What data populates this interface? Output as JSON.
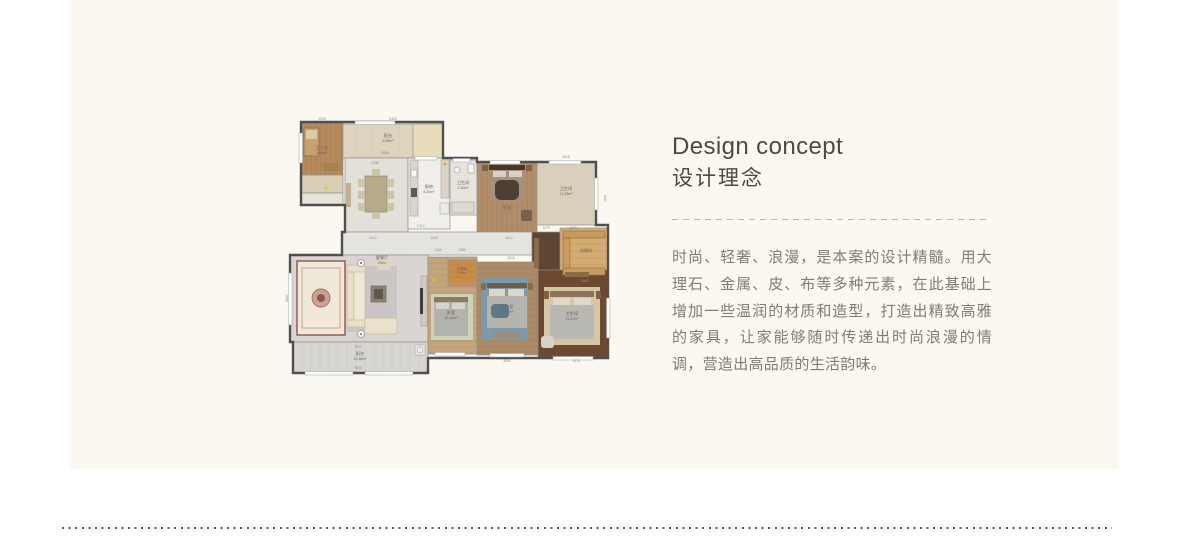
{
  "page": {
    "background": "#ffffff",
    "panel_bg": "#faf8f0"
  },
  "content": {
    "heading_en": "Design concept",
    "heading_zh": "设计理念",
    "paragraph": "时尚、轻奢、浪漫，是本案的设计精髓。用大理石、金属、皮、布等多种元素，在此基础上增加一些温润的材质和造型，打造出精致高雅的家具，让家能够随时传递出时尚浪漫的情调，营造出高品质的生活韵味。"
  },
  "floorplan": {
    "colors": {
      "wall": "#4f4f4f",
      "inner_wall": "#8f8f8f",
      "label": "#6a665e",
      "dim": "#8c8c8c"
    },
    "outline": "M16,14 H158 V50 H192 V54 H311 V117 H323 V250 H143 V265 H8 V234 H5 V147 H57 V124 H60 V97 H16 Z",
    "rooms": [
      {
        "name": "study",
        "x": 16,
        "y": 15,
        "w": 42,
        "h": 52,
        "fill": "#b58a5c"
      },
      {
        "name": "study-closet",
        "x": 16,
        "y": 67,
        "w": 42,
        "h": 18,
        "fill": "#d9cfb6"
      },
      {
        "name": "study-terrace",
        "x": 16,
        "y": 85,
        "w": 42,
        "h": 12,
        "fill": "#e7e3d8"
      },
      {
        "name": "balcony-top",
        "x": 58,
        "y": 16,
        "w": 100,
        "h": 34,
        "fill": "#ddd3bf"
      },
      {
        "name": "balcony-top-cabinet",
        "x": 128,
        "y": 16,
        "w": 30,
        "h": 34,
        "fill": "#e9dcba"
      },
      {
        "name": "dining",
        "x": 60,
        "y": 50,
        "w": 63,
        "h": 74,
        "fill": "#e3e0da"
      },
      {
        "name": "kitchen",
        "x": 123,
        "y": 50,
        "w": 42,
        "h": 71,
        "fill": "#f0efeb"
      },
      {
        "name": "bath-small",
        "x": 165,
        "y": 52,
        "w": 27,
        "h": 55,
        "fill": "#e6e4df"
      },
      {
        "name": "bedroom-top",
        "x": 192,
        "y": 54,
        "w": 60,
        "h": 70,
        "fill": "#b18d6a"
      },
      {
        "name": "bath-top-right",
        "x": 252,
        "y": 54,
        "w": 59,
        "h": 63,
        "fill": "#d8d0bd"
      },
      {
        "name": "corridor",
        "x": 57,
        "y": 124,
        "w": 190,
        "h": 23,
        "fill": "#e6e4df"
      },
      {
        "name": "entry",
        "x": 247,
        "y": 124,
        "w": 30,
        "h": 45,
        "fill": "#5e4534"
      },
      {
        "name": "closet-right",
        "x": 275,
        "y": 120,
        "w": 48,
        "h": 49,
        "fill": "#d3ac73"
      },
      {
        "name": "living",
        "x": 5,
        "y": 147,
        "w": 138,
        "h": 87,
        "fill": "#dad5d3"
      },
      {
        "name": "balcony-bottom",
        "x": 8,
        "y": 234,
        "w": 135,
        "h": 31,
        "fill": "#d8d6d2"
      },
      {
        "name": "bedroom-left",
        "x": 143,
        "y": 149,
        "w": 49,
        "h": 97,
        "fill": "#c2a57c"
      },
      {
        "name": "closet-small",
        "x": 163,
        "y": 152,
        "w": 29,
        "h": 26,
        "fill": "#c98d4e"
      },
      {
        "name": "bedroom-mid",
        "x": 192,
        "y": 154,
        "w": 61,
        "h": 93,
        "fill": "#aa8a67"
      },
      {
        "name": "bedroom-right",
        "x": 253,
        "y": 162,
        "w": 70,
        "h": 88,
        "fill": "#6f4a33"
      }
    ],
    "textures": [
      {
        "x": 16,
        "y": 15,
        "w": 42,
        "h": 52,
        "dir": "v",
        "gap": 5,
        "color": "#9a7348"
      },
      {
        "x": 58,
        "y": 16,
        "w": 70,
        "h": 34,
        "dir": "v",
        "gap": 14,
        "color": "#cfc5ae"
      },
      {
        "x": 192,
        "y": 54,
        "w": 60,
        "h": 70,
        "dir": "v",
        "gap": 5,
        "color": "#97765a"
      },
      {
        "x": 277,
        "y": 122,
        "w": 44,
        "h": 45,
        "dir": "h",
        "gap": 7,
        "color": "#b68a4f"
      },
      {
        "x": 5,
        "y": 147,
        "w": 138,
        "h": 87,
        "dir": "v",
        "gap": 11,
        "color": "#ccc7c5"
      },
      {
        "x": 8,
        "y": 234,
        "w": 135,
        "h": 31,
        "dir": "v",
        "gap": 9,
        "color": "#bcbab6"
      },
      {
        "x": 143,
        "y": 149,
        "w": 49,
        "h": 97,
        "dir": "h",
        "gap": 6,
        "color": "#a98c64"
      },
      {
        "x": 192,
        "y": 154,
        "w": 61,
        "h": 93,
        "dir": "h",
        "gap": 6,
        "color": "#94775a"
      },
      {
        "x": 253,
        "y": 162,
        "w": 70,
        "h": 88,
        "dir": "v",
        "gap": 4,
        "color": "#5d3c28"
      }
    ],
    "furniture": [
      {
        "x": 19,
        "y": 20,
        "w": 15,
        "h": 28,
        "fill": "#c9a26b",
        "stroke": "#8a6a42"
      },
      {
        "x": 21,
        "y": 22,
        "w": 11,
        "h": 9,
        "fill": "#ddc9a2"
      },
      {
        "x": 38,
        "y": 55,
        "w": 16,
        "h": 8,
        "fill": "#a87f4f"
      },
      {
        "type": "c",
        "x": 41,
        "y": 80,
        "r": 1.5,
        "fill": "#e8c02c"
      },
      {
        "x": 80,
        "y": 68,
        "w": 22,
        "h": 36,
        "fill": "#b6aa8d",
        "stroke": "#8f8468"
      },
      {
        "x": 73,
        "y": 71,
        "w": 6,
        "h": 8,
        "fill": "#cec4a8"
      },
      {
        "x": 73,
        "y": 83,
        "w": 6,
        "h": 8,
        "fill": "#cec4a8"
      },
      {
        "x": 73,
        "y": 95,
        "w": 6,
        "h": 8,
        "fill": "#cec4a8"
      },
      {
        "x": 103,
        "y": 71,
        "w": 6,
        "h": 8,
        "fill": "#cec4a8"
      },
      {
        "x": 103,
        "y": 83,
        "w": 6,
        "h": 8,
        "fill": "#cec4a8"
      },
      {
        "x": 103,
        "y": 95,
        "w": 6,
        "h": 8,
        "fill": "#cec4a8"
      },
      {
        "x": 87,
        "y": 61,
        "w": 8,
        "h": 6,
        "fill": "#cec4a8"
      },
      {
        "x": 87,
        "y": 105,
        "w": 8,
        "h": 6,
        "fill": "#cec4a8"
      },
      {
        "x": 61,
        "y": 75,
        "w": 5,
        "h": 24,
        "fill": "#c2b191"
      },
      {
        "x": 125,
        "y": 52,
        "w": 8,
        "h": 56,
        "fill": "#dbd5c9",
        "stroke": "#b5ad9c"
      },
      {
        "x": 156,
        "y": 52,
        "w": 8,
        "h": 38,
        "fill": "#dbd5c9",
        "stroke": "#b5ad9c"
      },
      {
        "x": 126,
        "y": 62,
        "w": 6,
        "h": 7,
        "fill": "#f6f5f2",
        "stroke": "#aaaaaa"
      },
      {
        "x": 126,
        "y": 80,
        "w": 6,
        "h": 9,
        "fill": "#5a5a58"
      },
      {
        "x": 155,
        "y": 95,
        "w": 9,
        "h": 11,
        "fill": "#eceae4",
        "stroke": "#b3b0a8"
      },
      {
        "type": "c",
        "x": 160,
        "y": 56,
        "r": 1.5,
        "fill": "#e8a42c"
      },
      {
        "type": "c",
        "x": 172,
        "y": 62,
        "r": 3,
        "fill": "#f7f6f3",
        "stroke": "#a9a6a0"
      },
      {
        "x": 183,
        "y": 56,
        "w": 6,
        "h": 9,
        "fill": "#f7f6f3",
        "stroke": "#a9a6a0"
      },
      {
        "x": 167,
        "y": 94,
        "w": 22,
        "h": 11,
        "fill": "#dedbd3",
        "stroke": "#a9a6a0"
      },
      {
        "x": 204,
        "y": 57,
        "w": 36,
        "h": 5,
        "fill": "#46372e"
      },
      {
        "x": 206,
        "y": 62,
        "w": 32,
        "h": 32,
        "fill": "#a39181"
      },
      {
        "x": 208,
        "y": 63,
        "w": 13,
        "h": 6,
        "fill": "#d9d1c2"
      },
      {
        "x": 224,
        "y": 63,
        "w": 13,
        "h": 6,
        "fill": "#d9d1c2"
      },
      {
        "x": 210,
        "y": 72,
        "w": 24,
        "h": 20,
        "fill": "#4e3e33",
        "rx": 6
      },
      {
        "x": 197,
        "y": 57,
        "w": 6,
        "h": 6,
        "fill": "#7c6347"
      },
      {
        "x": 241,
        "y": 57,
        "w": 6,
        "h": 6,
        "fill": "#7c6347"
      },
      {
        "x": 236,
        "y": 102,
        "w": 11,
        "h": 11,
        "fill": "#77624e",
        "rx": 2
      },
      {
        "x": 278,
        "y": 123,
        "w": 42,
        "h": 7,
        "fill": "#c79a5e",
        "stroke": "#9e7338"
      },
      {
        "x": 278,
        "y": 160,
        "w": 42,
        "h": 7,
        "fill": "#c79a5e",
        "stroke": "#9e7338"
      },
      {
        "x": 278,
        "y": 130,
        "w": 7,
        "h": 30,
        "fill": "#c79a5e",
        "stroke": "#9e7338"
      },
      {
        "x": 249,
        "y": 130,
        "w": 5,
        "h": 30,
        "fill": "#8a6a4a"
      },
      {
        "x": 12,
        "y": 153,
        "w": 48,
        "h": 74,
        "fill": "#f0e8d9",
        "stroke": "#8d5450",
        "sw": 1.4
      },
      {
        "x": 17,
        "y": 160,
        "w": 38,
        "h": 60,
        "fill": "none",
        "stroke": "#b08a78",
        "sw": 0.7
      },
      {
        "type": "c",
        "x": 36,
        "y": 190,
        "r": 9,
        "fill": "#cba095",
        "stroke": "#8d5450"
      },
      {
        "type": "c",
        "x": 36,
        "y": 190,
        "r": 4,
        "fill": "#8d5450"
      },
      {
        "x": 62,
        "y": 158,
        "w": 50,
        "h": 66,
        "fill": "#cbc5c5"
      },
      {
        "x": 62,
        "y": 163,
        "w": 7,
        "h": 50,
        "fill": "#e7dfc8",
        "stroke": "#c4bba0"
      },
      {
        "x": 69,
        "y": 163,
        "w": 11,
        "h": 50,
        "fill": "#efe8d3",
        "stroke": "#c4bba0"
      },
      {
        "x": 62,
        "y": 157,
        "w": 18,
        "h": 7,
        "fill": "#e7dfc8",
        "stroke": "#c4bba0"
      },
      {
        "x": 62,
        "y": 212,
        "w": 18,
        "h": 7,
        "fill": "#e7dfc8",
        "stroke": "#c4bba0"
      },
      {
        "x": 80,
        "y": 210,
        "w": 32,
        "h": 16,
        "fill": "#e9e1cb",
        "stroke": "#c4bba0",
        "rx": 2
      },
      {
        "x": 92,
        "y": 152,
        "w": 14,
        "h": 10,
        "fill": "#ded5bd",
        "rx": 3
      },
      {
        "x": 86,
        "y": 178,
        "w": 15,
        "h": 16,
        "fill": "#8b8276",
        "stroke": "#6d655a"
      },
      {
        "x": 89,
        "y": 181,
        "w": 9,
        "h": 10,
        "fill": "#5f584e"
      },
      {
        "type": "c",
        "x": 76,
        "y": 155,
        "r": 3.5,
        "fill": "#fbfaf7",
        "stroke": "#8f8f8f"
      },
      {
        "type": "c",
        "x": 76,
        "y": 155,
        "r": 1,
        "fill": "#6f6f6f"
      },
      {
        "type": "c",
        "x": 76,
        "y": 226,
        "r": 3.5,
        "fill": "#fbfaf7",
        "stroke": "#8f8f8f"
      },
      {
        "type": "c",
        "x": 76,
        "y": 226,
        "r": 1,
        "fill": "#6f6f6f"
      },
      {
        "x": 136,
        "y": 168,
        "w": 6,
        "h": 50,
        "fill": "#cfcac2",
        "stroke": "#a8a49c"
      },
      {
        "x": 135,
        "y": 180,
        "w": 3,
        "h": 26,
        "fill": "#3c3c3c"
      },
      {
        "x": 130,
        "y": 237,
        "w": 10,
        "h": 10,
        "fill": "#ecebe7",
        "stroke": "#b0ada6"
      },
      {
        "type": "c",
        "x": 135,
        "y": 242,
        "r": 3,
        "fill": "none",
        "stroke": "#b0ada6"
      },
      {
        "x": 165,
        "y": 156,
        "w": 26,
        "h": 3,
        "fill": "#c8883f"
      },
      {
        "x": 165,
        "y": 162,
        "w": 26,
        "h": 3,
        "fill": "#c8883f"
      },
      {
        "x": 165,
        "y": 168,
        "w": 26,
        "h": 3,
        "fill": "#c8883f"
      },
      {
        "x": 146,
        "y": 186,
        "w": 42,
        "h": 46,
        "fill": "#cdd3b6"
      },
      {
        "x": 149,
        "y": 189,
        "w": 34,
        "h": 5,
        "fill": "#8f7a5f"
      },
      {
        "x": 149,
        "y": 194,
        "w": 34,
        "h": 34,
        "fill": "#b4b2ad"
      },
      {
        "x": 151,
        "y": 195,
        "w": 13,
        "h": 6,
        "fill": "#d9d4c9"
      },
      {
        "x": 167,
        "y": 195,
        "w": 13,
        "h": 6,
        "fill": "#d9d4c9"
      },
      {
        "type": "c",
        "x": 149,
        "y": 172,
        "r": 1.5,
        "fill": "#e8c02c"
      },
      {
        "x": 197,
        "y": 170,
        "w": 46,
        "h": 62,
        "fill": "#7d99aa"
      },
      {
        "x": 202,
        "y": 175,
        "w": 40,
        "h": 5,
        "fill": "#6e5d4c"
      },
      {
        "x": 204,
        "y": 181,
        "w": 16,
        "h": 7,
        "fill": "#ddd6c8"
      },
      {
        "x": 223,
        "y": 181,
        "w": 16,
        "h": 7,
        "fill": "#ddd6c8"
      },
      {
        "x": 202,
        "y": 188,
        "w": 40,
        "h": 32,
        "fill": "#b6b4af"
      },
      {
        "x": 206,
        "y": 196,
        "w": 18,
        "h": 14,
        "fill": "#5e7888",
        "rx": 4
      },
      {
        "x": 196,
        "y": 175,
        "w": 5,
        "h": 7,
        "fill": "#846d50"
      },
      {
        "x": 243,
        "y": 175,
        "w": 5,
        "h": 7,
        "fill": "#846d50"
      },
      {
        "x": 209,
        "y": 223,
        "w": 26,
        "h": 7,
        "fill": "#9b8d79"
      },
      {
        "x": 259,
        "y": 179,
        "w": 56,
        "h": 58,
        "fill": "#d7c6a6"
      },
      {
        "x": 280,
        "y": 164,
        "w": 24,
        "h": 5,
        "fill": "#8a6a48"
      },
      {
        "x": 265,
        "y": 183,
        "w": 44,
        "h": 6,
        "fill": "#8a7357"
      },
      {
        "x": 268,
        "y": 190,
        "w": 17,
        "h": 7,
        "fill": "#e0d9cb"
      },
      {
        "x": 289,
        "y": 190,
        "w": 17,
        "h": 7,
        "fill": "#e0d9cb"
      },
      {
        "x": 265,
        "y": 197,
        "w": 44,
        "h": 34,
        "fill": "#bab8b2"
      },
      {
        "x": 259,
        "y": 183,
        "w": 5,
        "h": 8,
        "fill": "#7c6347"
      },
      {
        "x": 311,
        "y": 183,
        "w": 5,
        "h": 8,
        "fill": "#7c6347"
      },
      {
        "x": 256,
        "y": 228,
        "w": 13,
        "h": 12,
        "fill": "#d9d2c4",
        "rx": 3
      }
    ],
    "windows": [
      {
        "x": 70,
        "y": 13,
        "w": 40,
        "h": 3.5
      },
      {
        "x": 14,
        "y": 25,
        "w": 3.5,
        "h": 30
      },
      {
        "x": 130,
        "y": 48.5,
        "w": 22,
        "h": 3.5
      },
      {
        "x": 168,
        "y": 50.5,
        "w": 17,
        "h": 3.5
      },
      {
        "x": 205,
        "y": 52.5,
        "w": 30,
        "h": 3.5
      },
      {
        "x": 264,
        "y": 52.5,
        "w": 32,
        "h": 3.5
      },
      {
        "x": 309.5,
        "y": 70,
        "w": 3.5,
        "h": 32
      },
      {
        "x": 321.5,
        "y": 190,
        "w": 3.5,
        "h": 40
      },
      {
        "x": 3.5,
        "y": 165,
        "w": 3.5,
        "h": 52
      },
      {
        "x": 20,
        "y": 263.5,
        "w": 48,
        "h": 3.5
      },
      {
        "x": 80,
        "y": 263.5,
        "w": 48,
        "h": 3.5
      },
      {
        "x": 150,
        "y": 244.5,
        "w": 30,
        "h": 3.5
      },
      {
        "x": 205,
        "y": 245.5,
        "w": 34,
        "h": 3.5
      },
      {
        "x": 268,
        "y": 248.5,
        "w": 40,
        "h": 3.5
      }
    ],
    "labels": [
      {
        "t": "工人房",
        "x": 37,
        "y": 41
      },
      {
        "t": "6.54m²",
        "x": 37,
        "y": 46,
        "s": 3.6
      },
      {
        "t": "阳台",
        "x": 103,
        "y": 29
      },
      {
        "t": "9.06m²",
        "x": 103,
        "y": 34,
        "s": 3.6
      },
      {
        "t": "厨房",
        "x": 144,
        "y": 80
      },
      {
        "t": "8.30m²",
        "x": 144,
        "y": 85,
        "s": 3.6
      },
      {
        "t": "卫生间",
        "x": 178,
        "y": 76
      },
      {
        "t": "2.40m²",
        "x": 178,
        "y": 81,
        "s": 3.6
      },
      {
        "t": "卧室",
        "x": 222,
        "y": 101
      },
      {
        "t": "卫生间",
        "x": 281,
        "y": 82
      },
      {
        "t": "11.29m²",
        "x": 281,
        "y": 87,
        "s": 3.6
      },
      {
        "t": "衣帽间",
        "x": 301,
        "y": 144
      },
      {
        "t": "客餐厅",
        "x": 97,
        "y": 151
      },
      {
        "t": "29m²",
        "x": 97,
        "y": 156,
        "s": 3.4
      },
      {
        "t": "阳台",
        "x": 75,
        "y": 247
      },
      {
        "t": "10.36m²",
        "x": 75,
        "y": 252,
        "s": 3.6
      },
      {
        "t": "衣帽间",
        "x": 177,
        "y": 162,
        "s": 3.4
      },
      {
        "t": "3.69m²",
        "x": 177,
        "y": 166,
        "s": 3.2
      },
      {
        "t": "卧室",
        "x": 166,
        "y": 206
      },
      {
        "t": "13.16m²",
        "x": 166,
        "y": 211,
        "s": 3.6
      },
      {
        "t": "主卧室",
        "x": 222,
        "y": 200
      },
      {
        "t": "16.14m²",
        "x": 222,
        "y": 205,
        "s": 3.6
      },
      {
        "t": "主卧室",
        "x": 287,
        "y": 207
      },
      {
        "t": "11.37m²",
        "x": 287,
        "y": 212,
        "s": 3.6
      }
    ],
    "dims": [
      {
        "t": "1944",
        "x": 37,
        "y": 12
      },
      {
        "t": "5420",
        "x": 108,
        "y": 12
      },
      {
        "t": "3556",
        "x": 100,
        "y": 46
      },
      {
        "t": "3436",
        "x": 90,
        "y": 56
      },
      {
        "t": "2112",
        "x": 136,
        "y": 119
      },
      {
        "t": "2412",
        "x": 88,
        "y": 131
      },
      {
        "t": "1635",
        "x": 149,
        "y": 131
      },
      {
        "t": "3612",
        "x": 224,
        "y": 131
      },
      {
        "t": "1346",
        "x": 153,
        "y": 143
      },
      {
        "t": "1095",
        "x": 177,
        "y": 143
      },
      {
        "t": "3212",
        "x": 226,
        "y": 151
      },
      {
        "t": "3018",
        "x": 281,
        "y": 50
      },
      {
        "t": "1079",
        "x": 261,
        "y": 121
      },
      {
        "t": "1929",
        "x": 288,
        "y": 121
      },
      {
        "t": "2652",
        "x": 300,
        "y": 174
      },
      {
        "t": "7620",
        "x": 73,
        "y": 240
      },
      {
        "t": "7620",
        "x": 73,
        "y": 261
      },
      {
        "t": "3050",
        "x": 222,
        "y": 254
      },
      {
        "t": "1075",
        "x": 291,
        "y": 254
      },
      {
        "t": "6840",
        "x": 3,
        "y": 190,
        "r": -90
      },
      {
        "t": "1640",
        "x": 319,
        "y": 90,
        "r": 90
      }
    ]
  }
}
